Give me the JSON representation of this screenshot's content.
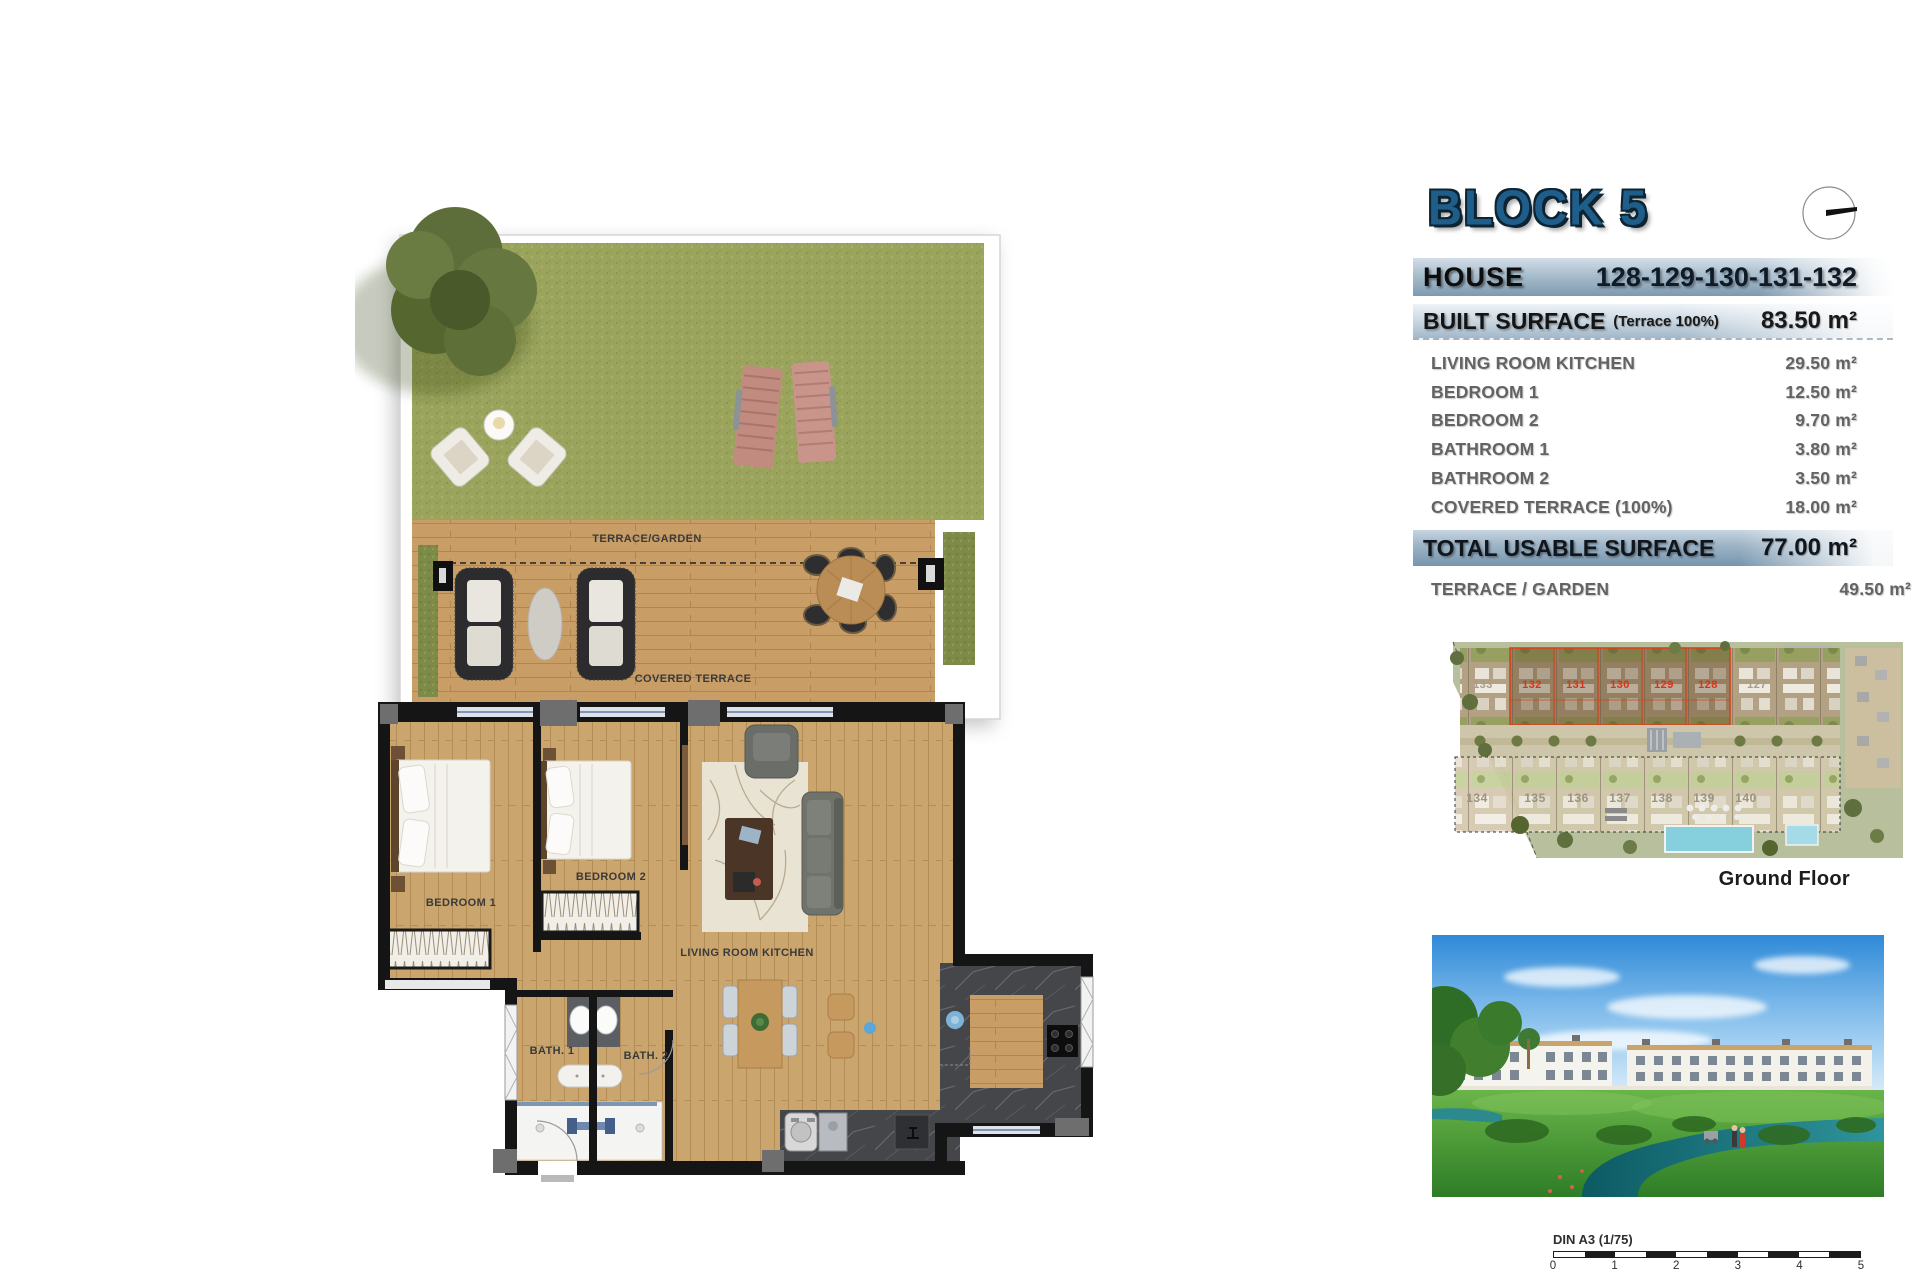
{
  "header": {
    "title": "BLOCK 5"
  },
  "table": {
    "house_label": "HOUSE",
    "house_numbers": "128-129-130-131-132",
    "built_surface_label": "BUILT SURFACE",
    "built_surface_note": "(Terrace 100%)",
    "built_surface_value": "83.50 m²",
    "rows": [
      {
        "label": "LIVING ROOM KITCHEN",
        "value": "29.50 m²"
      },
      {
        "label": "BEDROOM 1",
        "value": "12.50 m²"
      },
      {
        "label": "BEDROOM 2",
        "value": "9.70 m²"
      },
      {
        "label": "BATHROOM 1",
        "value": "3.80 m²"
      },
      {
        "label": "BATHROOM 2",
        "value": "3.50 m²"
      },
      {
        "label": "COVERED TERRACE (100%)",
        "value": "18.00 m²"
      }
    ],
    "total_label": "TOTAL USABLE SURFACE",
    "total_value": "77.00 m²",
    "terrace_garden_label": "TERRACE / GARDEN",
    "terrace_garden_value": "49.50 m²"
  },
  "floor_plan": {
    "labels": {
      "terrace_garden": "TERRACE/GARDEN",
      "covered_terrace": "COVERED TERRACE",
      "bedroom1": "BEDROOM 1",
      "bedroom2": "BEDROOM 2",
      "living": "LIVING ROOM KITCHEN",
      "bath1": "BATH. 1",
      "bath2": "BATH. 2"
    }
  },
  "site_plan": {
    "caption": "Ground Floor",
    "left_unit": "133",
    "right_unit": "127",
    "highlighted_units": [
      "132",
      "131",
      "130",
      "129",
      "128"
    ],
    "bottom_row_units": [
      "134",
      "135",
      "136",
      "137",
      "138",
      "139",
      "140"
    ]
  },
  "scale_bar": {
    "label": "DIN A3 (1/75)",
    "ticks": [
      "0",
      "1",
      "2",
      "3",
      "4",
      "5"
    ]
  },
  "colors": {
    "accent_blue": "#1f5d8b",
    "bar_steel": "#7f9ab0",
    "highlight_red": "#d8331a",
    "grass_green": "#9aa45c",
    "wood": "#c89d66"
  }
}
